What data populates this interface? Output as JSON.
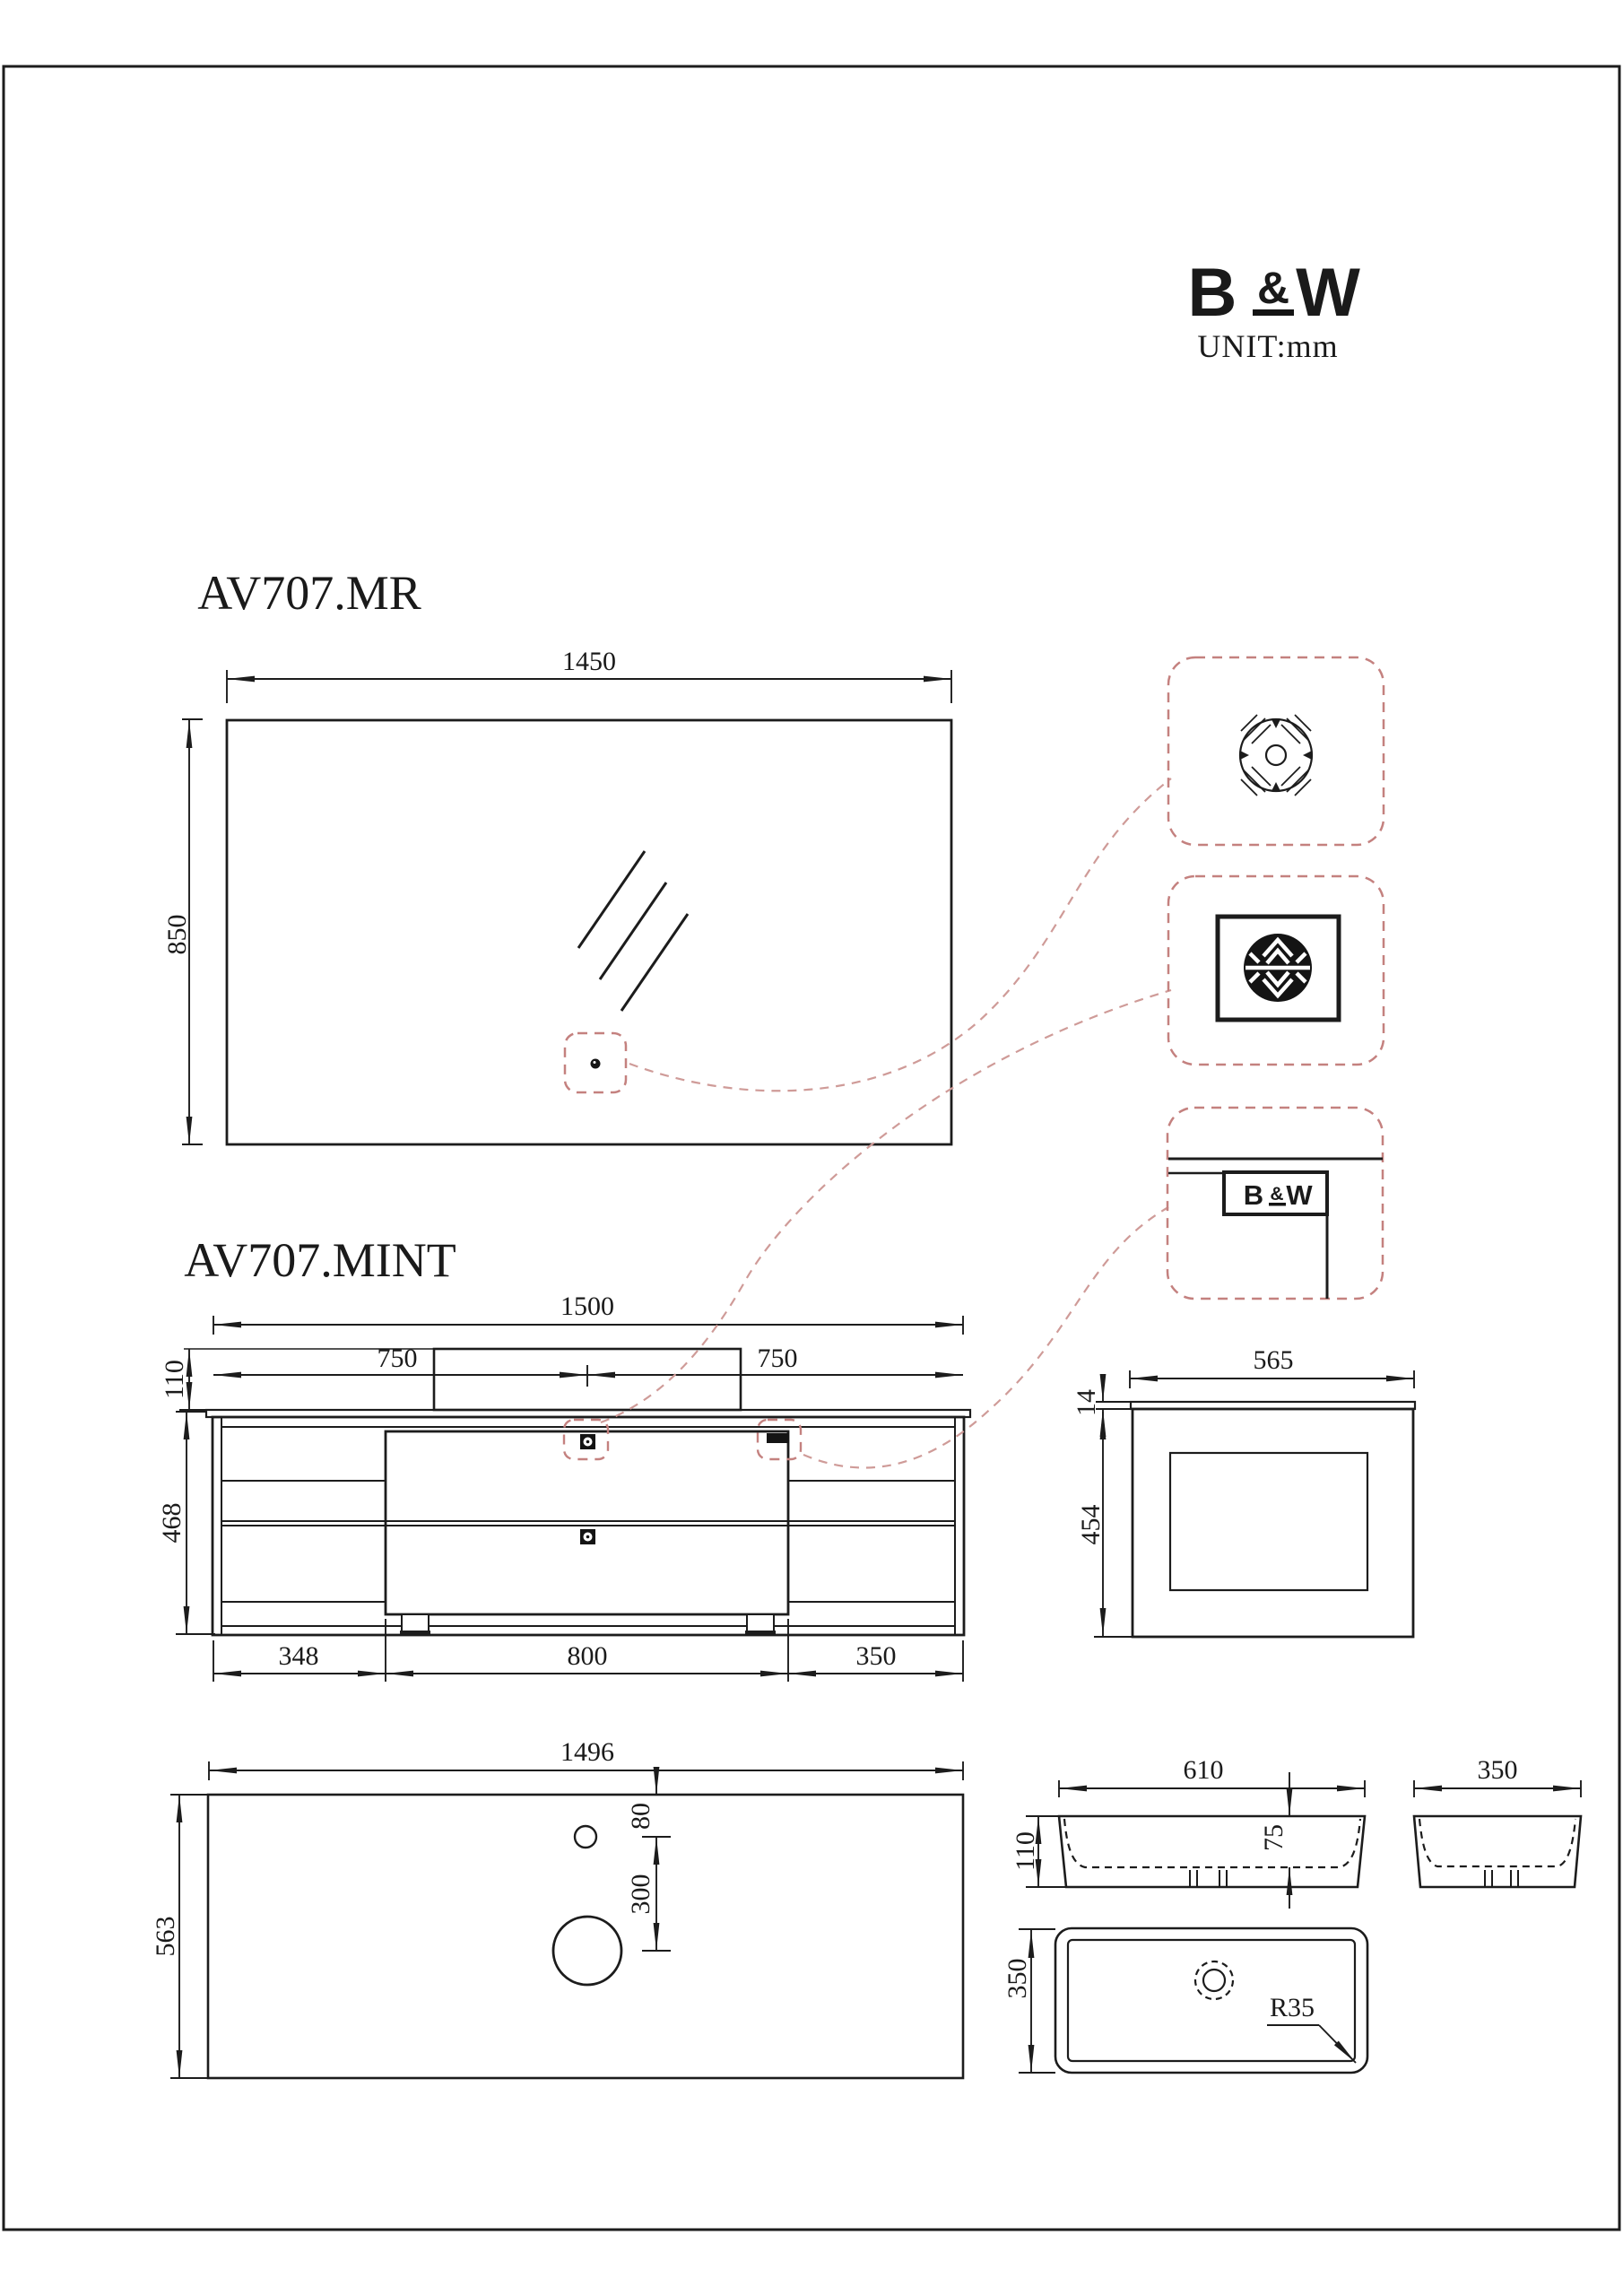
{
  "brand": {
    "b": "B",
    "amp": "&",
    "w": "W",
    "unit": "UNIT:mm"
  },
  "mirror": {
    "title": "AV707.MR",
    "width": "1450",
    "height": "850"
  },
  "vanity": {
    "title": "AV707.MINT",
    "total_width": "1500",
    "left_half": "750",
    "right_half": "750",
    "basin_height": "110",
    "body_height": "468",
    "bottom_left": "348",
    "bottom_center": "800",
    "bottom_right": "350"
  },
  "side_view": {
    "width": "565",
    "top_thickness": "14",
    "body_height": "454"
  },
  "countertop": {
    "width": "1496",
    "depth": "563",
    "faucet_offset": "80",
    "drain_offset": "300"
  },
  "basin": {
    "front_width": "610",
    "front_height": "110",
    "inner_depth": "75",
    "side_width": "350",
    "top_depth": "350",
    "corner_radius": "R35"
  },
  "badge": {
    "b": "B",
    "amp": "&",
    "w": "W"
  }
}
